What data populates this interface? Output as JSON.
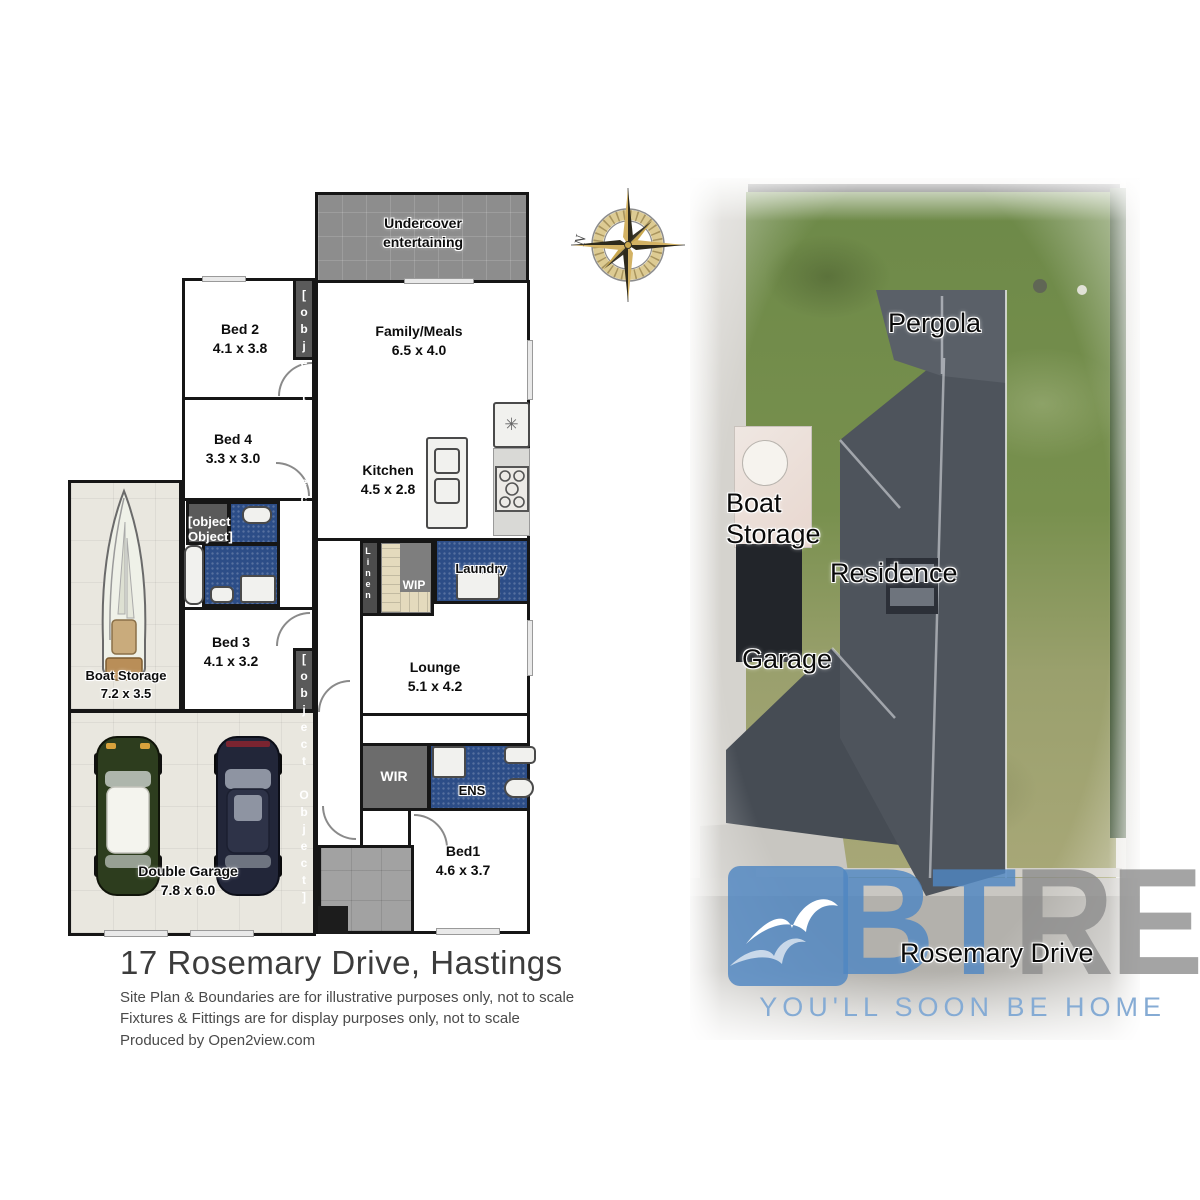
{
  "plan": {
    "rooms": {
      "undercover": {
        "name": "Undercover entertaining"
      },
      "bed2": {
        "name": "Bed 2",
        "dims": "4.1 x 3.8"
      },
      "family": {
        "name": "Family/Meals",
        "dims": "6.5 x 4.0"
      },
      "bed4": {
        "name": "Bed 4",
        "dims": "3.3 x 3.0"
      },
      "kitchen": {
        "name": "Kitchen",
        "dims": "4.5 x 2.8"
      },
      "laundry": {
        "name": "Laundry"
      },
      "wip": {
        "name": "WIP"
      },
      "linen": {
        "name": "Linen"
      },
      "bed3": {
        "name": "Bed 3",
        "dims": "4.1 x 3.2"
      },
      "lounge": {
        "name": "Lounge",
        "dims": "5.1 x 4.2"
      },
      "boat_storage": {
        "name": "Boat Storage",
        "dims": "7.2 x 3.5"
      },
      "garage": {
        "name": "Double Garage",
        "dims": "7.8 x 6.0"
      },
      "wir": {
        "name": "WIR"
      },
      "ens": {
        "name": "ENS"
      },
      "bed1": {
        "name": "Bed1",
        "dims": "4.6 x 3.7"
      },
      "bir": {
        "name": "BIR"
      }
    },
    "icons": {
      "fridge": "✳"
    }
  },
  "compass": {
    "north": "N"
  },
  "aerial": {
    "labels": {
      "pergola": "Pergola",
      "boat_storage": "Boat Storage",
      "residence": "Residence",
      "garage": "Garage",
      "street": "Rosemary Drive"
    }
  },
  "logo": {
    "bt": "BT",
    "re": "RE",
    "tagline": "YOU'LL SOON BE HOME"
  },
  "footer": {
    "title": "17 Rosemary Drive, Hastings",
    "line1": "Site Plan & Boundaries are for illustrative purposes only, not to scale",
    "line2": "Fixtures & Fittings are for display purposes only, not to scale",
    "line3": "Produced by Open2view.com"
  },
  "colors": {
    "wall": "#161616",
    "wet_blue": "#2c4d87",
    "closet_gray": "#5a5a5a",
    "roof_gray": "#4e545c",
    "grass_green": "#74894b",
    "logo_blue": "#4f86c2",
    "logo_gray": "#8b8b8b",
    "tagline_blue": "#85abd4"
  }
}
